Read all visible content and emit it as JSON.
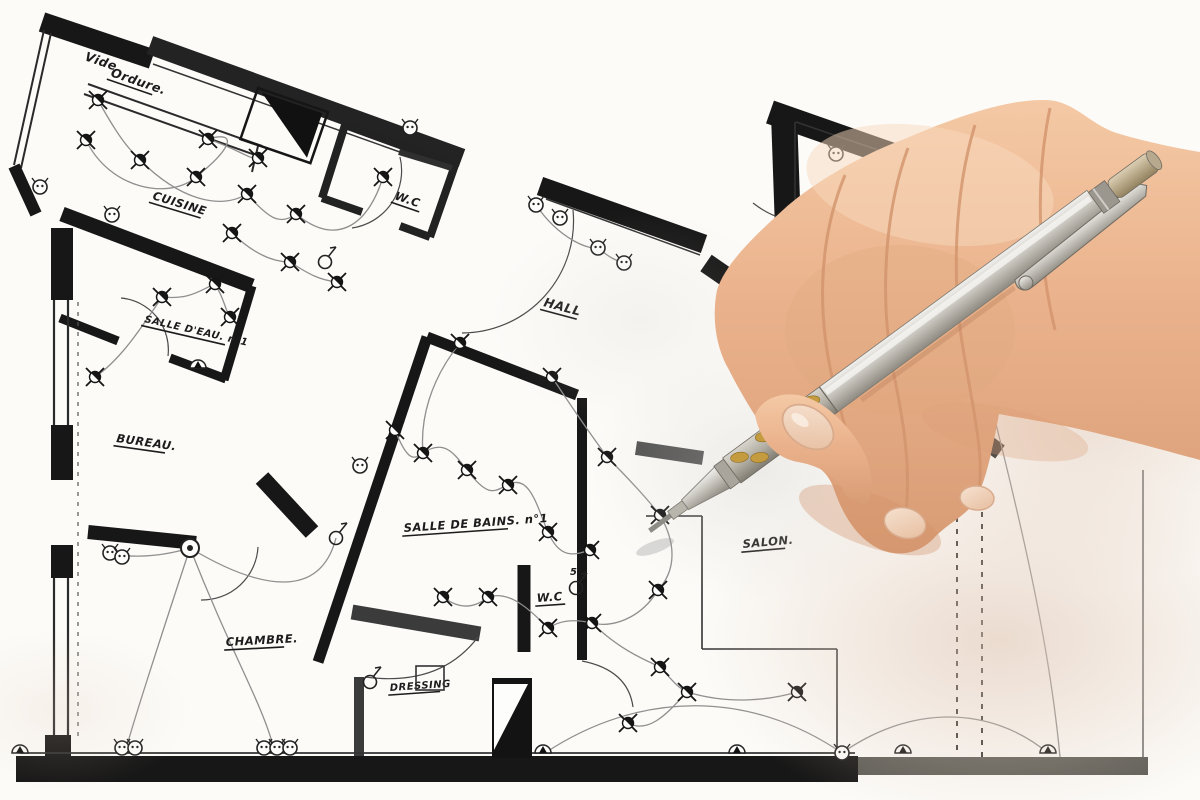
{
  "scene": {
    "type": "photo of a hand-drawn electrical floor plan being annotated with a mechanical pencil",
    "colors": {
      "paper": "#fbfaf7",
      "ink": "#1a1a1a",
      "wall_gray": "#3b3b3b",
      "wire_gray": "#8f8f8f",
      "skin": "#e9b28c",
      "skin_shadow": "#d08e66",
      "nail": "#f2d9c6",
      "pencil_silver": "#cdcac3",
      "pencil_dark": "#8f8c85",
      "grip_gold": "#c49b3e",
      "shadow_warm": "#e3cfc2"
    }
  },
  "floor_plan": {
    "labels": [
      {
        "id": "vide",
        "text": "Vide"
      },
      {
        "id": "ordure",
        "text": "Ordure."
      },
      {
        "id": "cuisine",
        "text": "CUISINE"
      },
      {
        "id": "wc-top",
        "text": "W.C"
      },
      {
        "id": "hall",
        "text": "HALL"
      },
      {
        "id": "salle-eau",
        "text": "SALLE D'EAU. n°1"
      },
      {
        "id": "bureau",
        "text": "BUREAU."
      },
      {
        "id": "salle-bains",
        "text": "SALLE DE BAINS. n°1"
      },
      {
        "id": "wc-mid",
        "text": "W.C"
      },
      {
        "id": "salon",
        "text": "SALON."
      },
      {
        "id": "chambre",
        "text": "CHAMBRE."
      },
      {
        "id": "dressing",
        "text": "DRESSING"
      },
      {
        "id": "circuit-5",
        "text": "5"
      }
    ],
    "legend": {
      "spotlight": "recessed ceiling spotlight symbol",
      "socket": "wall power socket symbol",
      "wall_light": "wall-mounted light symbol",
      "switch": "light switch symbol",
      "ceiling_light": "central ceiling light symbol"
    },
    "symbols": {
      "spotlights": [
        [
          98,
          100
        ],
        [
          86,
          140
        ],
        [
          140,
          160
        ],
        [
          196,
          177
        ],
        [
          208,
          139
        ],
        [
          258,
          158
        ],
        [
          247,
          194
        ],
        [
          296,
          214
        ],
        [
          232,
          233
        ],
        [
          383,
          177
        ],
        [
          162,
          297
        ],
        [
          215,
          284
        ],
        [
          230,
          317
        ],
        [
          95,
          377
        ],
        [
          290,
          262
        ],
        [
          337,
          282
        ],
        [
          460,
          343
        ],
        [
          552,
          377
        ],
        [
          395,
          430
        ],
        [
          423,
          453
        ],
        [
          467,
          470
        ],
        [
          508,
          485
        ],
        [
          548,
          532
        ],
        [
          590,
          550
        ],
        [
          607,
          457
        ],
        [
          660,
          515
        ],
        [
          658,
          590
        ],
        [
          592,
          623
        ],
        [
          548,
          628
        ],
        [
          443,
          597
        ],
        [
          488,
          597
        ],
        [
          660,
          667
        ],
        [
          687,
          692
        ],
        [
          797,
          692
        ],
        [
          628,
          723
        ]
      ],
      "sockets": [
        [
          410,
          128
        ],
        [
          836,
          154
        ],
        [
          536,
          205
        ],
        [
          560,
          218
        ],
        [
          598,
          248
        ],
        [
          624,
          263
        ],
        [
          40,
          187
        ],
        [
          112,
          215
        ],
        [
          110,
          553
        ],
        [
          122,
          557
        ],
        [
          122,
          748
        ],
        [
          135,
          748
        ],
        [
          264,
          748
        ],
        [
          277,
          748
        ],
        [
          290,
          748
        ],
        [
          842,
          753
        ],
        [
          360,
          466
        ]
      ],
      "wall_lights": [
        [
          20,
          753
        ],
        [
          543,
          753
        ],
        [
          737,
          753
        ],
        [
          903,
          753
        ],
        [
          1048,
          753
        ],
        [
          198,
          368
        ]
      ],
      "switches": [
        [
          325,
          262
        ],
        [
          336,
          538
        ],
        [
          370,
          682
        ],
        [
          576,
          588
        ]
      ],
      "ceiling_lights": [
        [
          190,
          548
        ]
      ]
    }
  }
}
